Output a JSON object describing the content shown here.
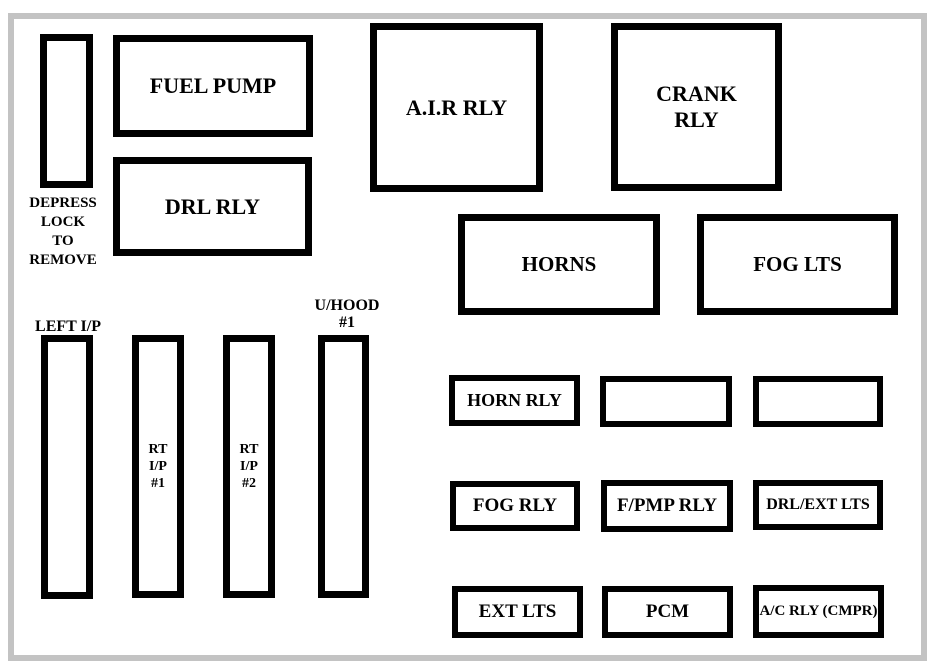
{
  "diagram": {
    "boxes": {
      "fuel_pump": {
        "label": "FUEL PUMP"
      },
      "drl_rly": {
        "label": "DRL RLY"
      },
      "air_rly": {
        "label": "A.I.R RLY"
      },
      "crank_rly": {
        "lines": [
          "CRANK",
          "RLY"
        ]
      },
      "horns": {
        "label": "HORNS"
      },
      "fog_lts": {
        "label": "FOG LTS"
      },
      "horn_rly": {
        "label": "HORN RLY"
      },
      "fog_rly": {
        "label": "FOG RLY"
      },
      "fpmp_rly": {
        "label": "F/PMP RLY"
      },
      "drl_ext_lts": {
        "label": "DRL/EXT LTS"
      },
      "ext_lts": {
        "label": "EXT LTS"
      },
      "pcm": {
        "label": "PCM"
      },
      "ac_rly_cmpr": {
        "label": "A/C RLY (CMPR)"
      }
    },
    "slots": {
      "depress_lock": {
        "caption_lines": [
          "DEPRESS",
          "LOCK",
          "TO",
          "REMOVE"
        ]
      },
      "left_ip": {
        "caption": "LEFT I/P"
      },
      "rt_ip_1": {
        "lines": [
          "RT I/P",
          "#1"
        ]
      },
      "rt_ip_2": {
        "lines": [
          "RT I/P",
          "#2"
        ]
      },
      "u_hood_1": {
        "caption_lines": [
          "U/HOOD",
          "#1"
        ]
      }
    },
    "colors": {
      "background": "#ffffff",
      "box_border": "#000000",
      "frame": "#c3c3c3",
      "text": "#000000"
    }
  }
}
